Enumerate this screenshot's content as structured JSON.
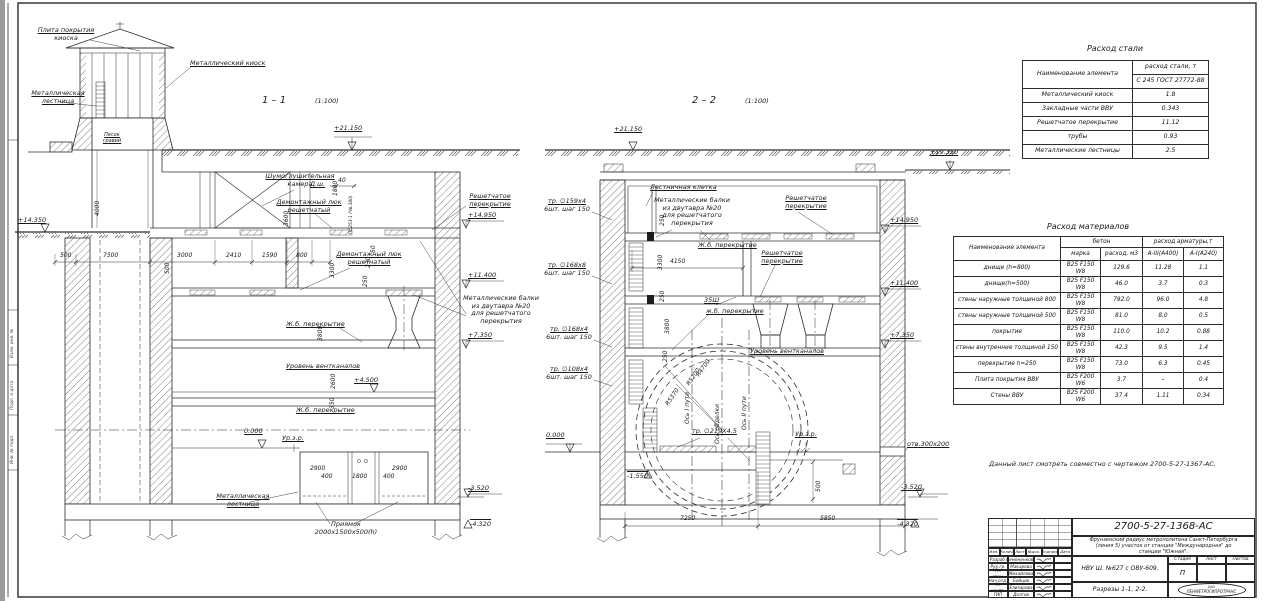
{
  "frame": {
    "f1": "Взам. инв. №",
    "f2": "Подп. и дата",
    "f3": "Инв. № подл."
  },
  "note": "Данный лист смотреть совместно с чертежом 2700-5-27-1367-АС.",
  "s1": {
    "title": "1 – 1",
    "scale": "(1:100)",
    "plate1": "Плита покрытия",
    "plate2": "киоска",
    "kiosk": "Металлический киоск",
    "lad1": "Металлическая",
    "lad2": "лестница",
    "sand1": "Песок",
    "sand2": "гравий",
    "noise1": "Шумоглушительная",
    "noise2": "камера",
    "dsh": "Д.ш.",
    "ps": "ПС253-1 (Чв.380)",
    "luk1a": "Демонтажный люк",
    "luk1b": "решетчатый",
    "luk2a": "Демонтажный люк",
    "luk2b": "решетчатый",
    "grate1": "Решетчатое",
    "grate2": "перекрытие",
    "beams1": "Металлические балки",
    "beams2": "из двутавра №20",
    "beams3": "для решетчатого",
    "beams4": "перекрытия",
    "slabA": "Ж.б. перекрытие",
    "slabB": "Ж.б. перекрытие",
    "vent": "Уровень вентканалов",
    "urzr": "Ур.з.р.",
    "ladb1": "Металлическая",
    "ladb2": "лестница",
    "pit1": "Приямок",
    "pit2": "2000х1500х500(h)",
    "e21150": "+21.150",
    "e14350": "+14.350",
    "e14950": "+14.950",
    "e11400": "+11.400",
    "e7350": "+7.350",
    "e4500": "+4.500",
    "e0": "0.000",
    "em3520": "-3.520",
    "em4320": "-4.320",
    "d40": "40",
    "d50": "50",
    "d230": "230",
    "d250": "250",
    "d500a": "500",
    "d7500": "7500",
    "d3000": "3000",
    "d2410": "2410",
    "d1590": "1590",
    "d800": "800",
    "d500b": "500",
    "d4000": "4000",
    "d1800": "1800",
    "d3600": "3600",
    "d3300": "3300",
    "d3800": "3800",
    "d2600": "2600",
    "d350": "350",
    "p2900a": "2900",
    "p400a": "400",
    "p1800": "1800",
    "p400b": "400",
    "p2900b": "2900"
  },
  "s2": {
    "title": "2 – 2",
    "scale": "(1:100)",
    "stair": "Лестничная клетка",
    "beams1": "Металлические балки",
    "beams2": "из двутавра №20",
    "beams3": "для решетчатого",
    "beams4": "перекрытия",
    "grateA1": "Решетчатое",
    "grateA2": "перекрытие",
    "grateB1": "Решетчатое",
    "grateB2": "перекрытие",
    "slabA": "Ж.б. перекрытие",
    "slabB": "ж.б. перекрытие",
    "sh35": "35Ш",
    "vent": "Уровень вентканалов",
    "tr1a": "тр. ∅159х4",
    "tr1b": "6шт. шаг 150",
    "tr2a": "тр. ∅168х8",
    "tr2b": "6шт. шаг 150",
    "tr3a": "тр. ∅168х4",
    "tr3b": "6шт. шаг 150",
    "tr4a": "тр. ∅108х4",
    "tr4b": "6шт. шаг 150",
    "r1": "R4700",
    "r2": "R5200",
    "r3": "R5370",
    "ax1": "Ось I пути",
    "ax2": "Ось обделки",
    "ax3": "Ось II пути",
    "tr219": "тр. ∅219Х4.5",
    "urzr": "Ур.з.р.",
    "otv": "отв.300х200",
    "e21150": "+21.150",
    "e19350": "+19.350",
    "e14950": "+14.950",
    "e11400": "+11.400",
    "e7350": "+7.350",
    "e0": "0.000",
    "em1550": "-1.550",
    "em3520": "-3.520",
    "em4320": "-4.320",
    "d4150": "4150",
    "d250a": "250",
    "d3300": "3300",
    "d250b": "250",
    "d3800": "3800",
    "d250c": "250",
    "d500": "500",
    "d7250": "7250",
    "d5850": "5850"
  },
  "steel": {
    "title": "Расход стали",
    "h_name": "Наименование элемента",
    "h_val1": "расход стали, т",
    "h_val2": "С 245 ГОСТ 27772-88",
    "rows": [
      {
        "n": "Металлический киоск",
        "v": "1.8"
      },
      {
        "n": "Закладные части ВВУ",
        "v": "0.343"
      },
      {
        "n": "Решетчатое перекрытие",
        "v": "11.12"
      },
      {
        "n": "трубы",
        "v": "0.93"
      },
      {
        "n": "Металлические лестницы",
        "v": "2.5"
      }
    ]
  },
  "mat": {
    "title": "Расход материалов",
    "h_name": "Наименование элемента",
    "h_conc": "бетон",
    "h_mark": "марка",
    "h_vol": "расход, м3",
    "h_arm": "расход арматуры,т",
    "h_a3": "А-III(А400)",
    "h_a1": "А-I(А240)",
    "rows": [
      [
        "днище (h=800)",
        "В25 F150 W8",
        "129.6",
        "11.28",
        "1.1"
      ],
      [
        "днище(h=500)",
        "В25 F150 W8",
        "46.0",
        "3.7",
        "0.3"
      ],
      [
        "стены наружные толщиной 800",
        "В25 F150 W8",
        "792.0",
        "96.0",
        "4.8"
      ],
      [
        "стены наружные толщиной 500",
        "В25 F150 W8",
        "81.0",
        "8,0",
        "0.5"
      ],
      [
        "покрытие",
        "В25 F150 W8",
        "110.0",
        "10.2",
        "0.88"
      ],
      [
        "стены внутренние толщиной 150",
        "В25 F150 W8",
        "42.3",
        "9.5",
        "1.4"
      ],
      [
        "перекрытие h=250",
        "В25 F150 W8",
        "73.0",
        "6.3",
        "0.45"
      ],
      [
        "Плита покрытия ВВУ",
        "В25 F200 W6",
        "3.7",
        "–",
        "0.4"
      ],
      [
        "Стены ВВУ",
        "В25 F200 W6",
        "37.4",
        "1.11",
        "0.34"
      ]
    ]
  },
  "tb": {
    "num": "2700-5-27-1368-АС",
    "desc1": "Фрунзенский радиус метрополитена Санкт-Петербурга",
    "desc2": "(линия 5) участок от станции \"Международная\" до",
    "desc3": "станции \"Южная\".",
    "obj": "НВУ Ш. №627 с ОВУ-609.",
    "sheet": "Разрезы 1-1, 2-2.",
    "stadia": "Стадия",
    "list": "Лист",
    "listov": "Листов",
    "stage": "П",
    "org1": "ОАО",
    "org2": "ЛЕНМЕТРОГИПРОТРАНС",
    "h1": "Изм.",
    "h2": "Колич.",
    "h3": "Лист",
    "h4": "№док.",
    "h5": "Подпись",
    "h6": "Дата",
    "roles": [
      [
        "Разраб.",
        "Семененкова"
      ],
      [
        "Рук.гр.",
        "Макарова"
      ],
      [
        "Гл. спец.",
        "Михайлова"
      ],
      [
        "Нач.отд.",
        "Бойцов"
      ],
      [
        "Н. контр.",
        "Елизарова"
      ],
      [
        "ГИП",
        "Долгов"
      ]
    ]
  }
}
